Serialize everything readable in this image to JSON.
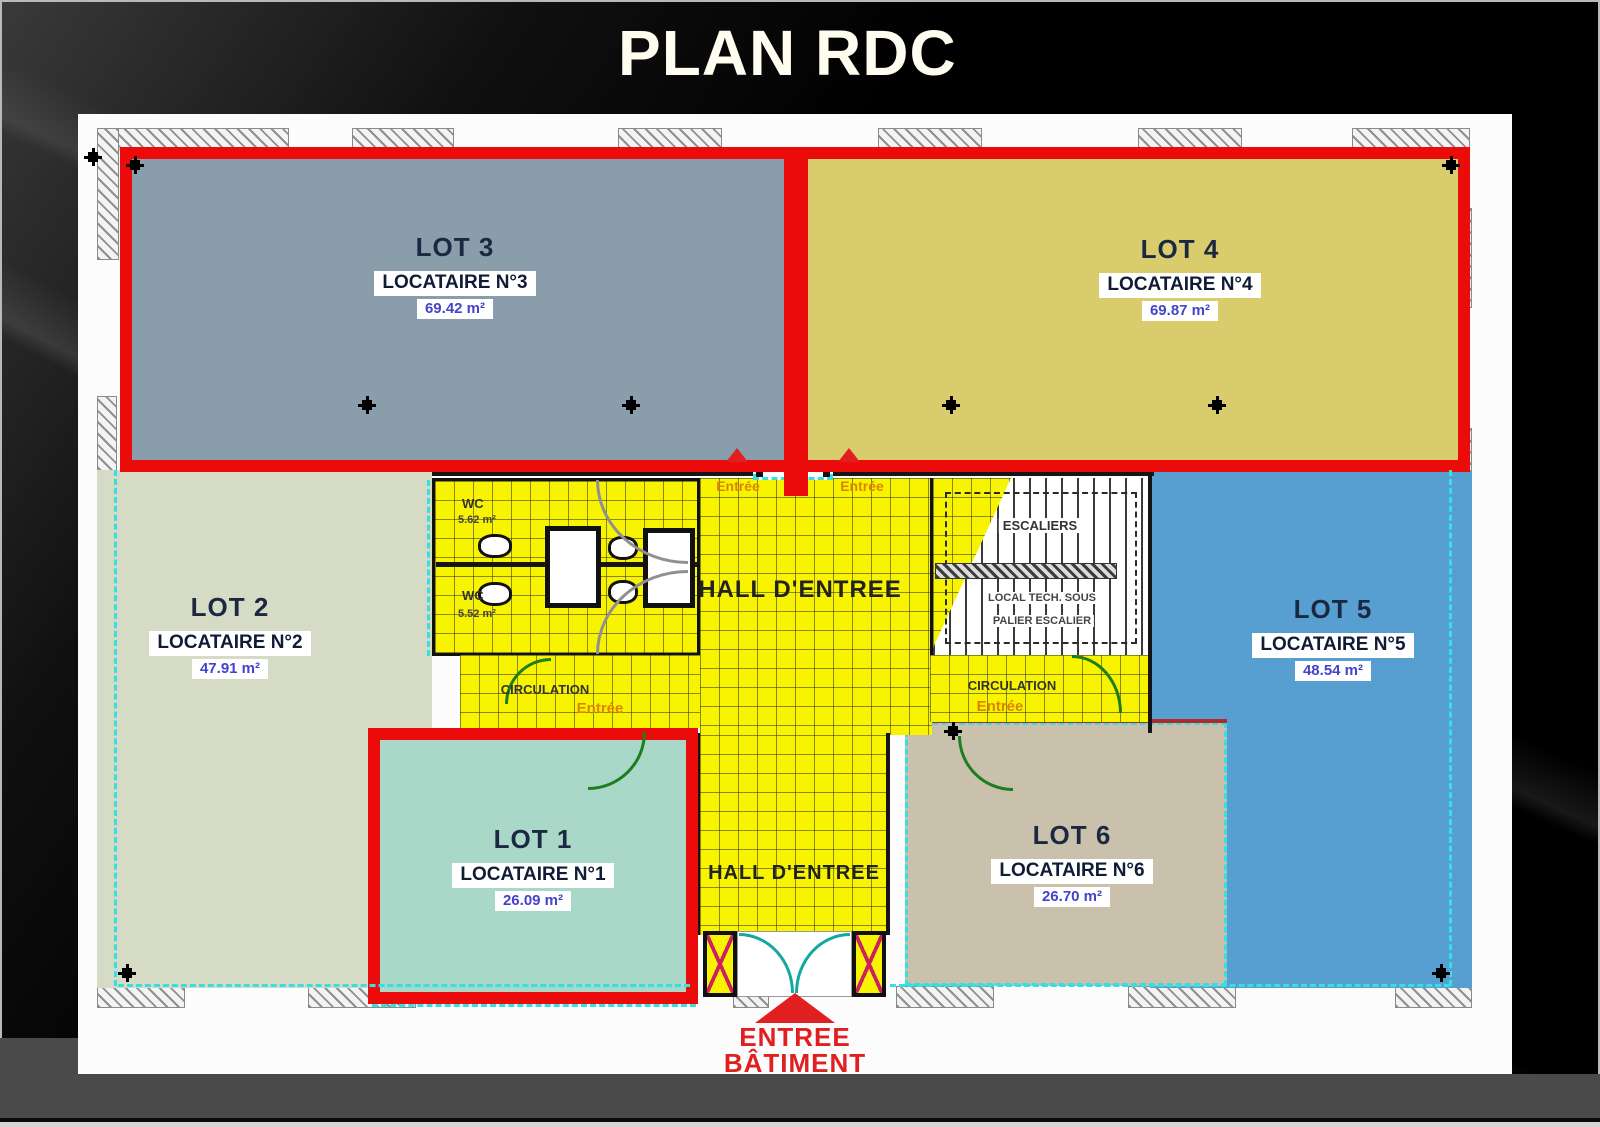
{
  "slide": {
    "title": "PLAN RDC"
  },
  "colors": {
    "highlight_red": "#ec0b0b",
    "lot1": "#a9d8c9",
    "lot2": "#d6dbc6",
    "lot3": "#8a9dab",
    "lot4": "#d9cc6c",
    "lot5": "#569fd0",
    "lot6": "#c9c1ac",
    "hall_yellow": "#f8f400",
    "cyan_dash": "#35dfe2"
  },
  "lots": {
    "lot1": {
      "name": "LOT 1",
      "tenant": "LOCATAIRE N°1",
      "area": "26.09 m²"
    },
    "lot2": {
      "name": "LOT 2",
      "tenant": "LOCATAIRE N°2",
      "area": "47.91 m²"
    },
    "lot3": {
      "name": "LOT 3",
      "tenant": "LOCATAIRE N°3",
      "area": "69.42 m²"
    },
    "lot4": {
      "name": "LOT 4",
      "tenant": "LOCATAIRE N°4",
      "area": "69.87 m²"
    },
    "lot5": {
      "name": "LOT 5",
      "tenant": "LOCATAIRE N°5",
      "area": "48.54 m²"
    },
    "lot6": {
      "name": "LOT 6",
      "tenant": "LOCATAIRE N°6",
      "area": "26.70 m²"
    }
  },
  "plan": {
    "hall_top": "HALL D'ENTREE",
    "hall_bottom": "HALL D'ENTREE",
    "wc_top": "WC",
    "wc_top_area": "5.62 m²",
    "wc_bottom": "WC",
    "wc_bottom_area": "5.52 m²",
    "stairs": "ESCALIERS",
    "local_tech_line1": "LOCAL TECH. SOUS",
    "local_tech_line2": "PALIER ESCALIER",
    "circulation_left": "CIRCULATION",
    "circulation_right": "CIRCULATION",
    "entree_top_left": "Entrée",
    "entree_top_right": "Entrée",
    "entree_circ_left": "Entrée",
    "entree_circ_right": "Entrée",
    "shaft": "V.O",
    "building_entrance_line1": "ENTREE",
    "building_entrance_line2": "BÂTIMENT"
  }
}
